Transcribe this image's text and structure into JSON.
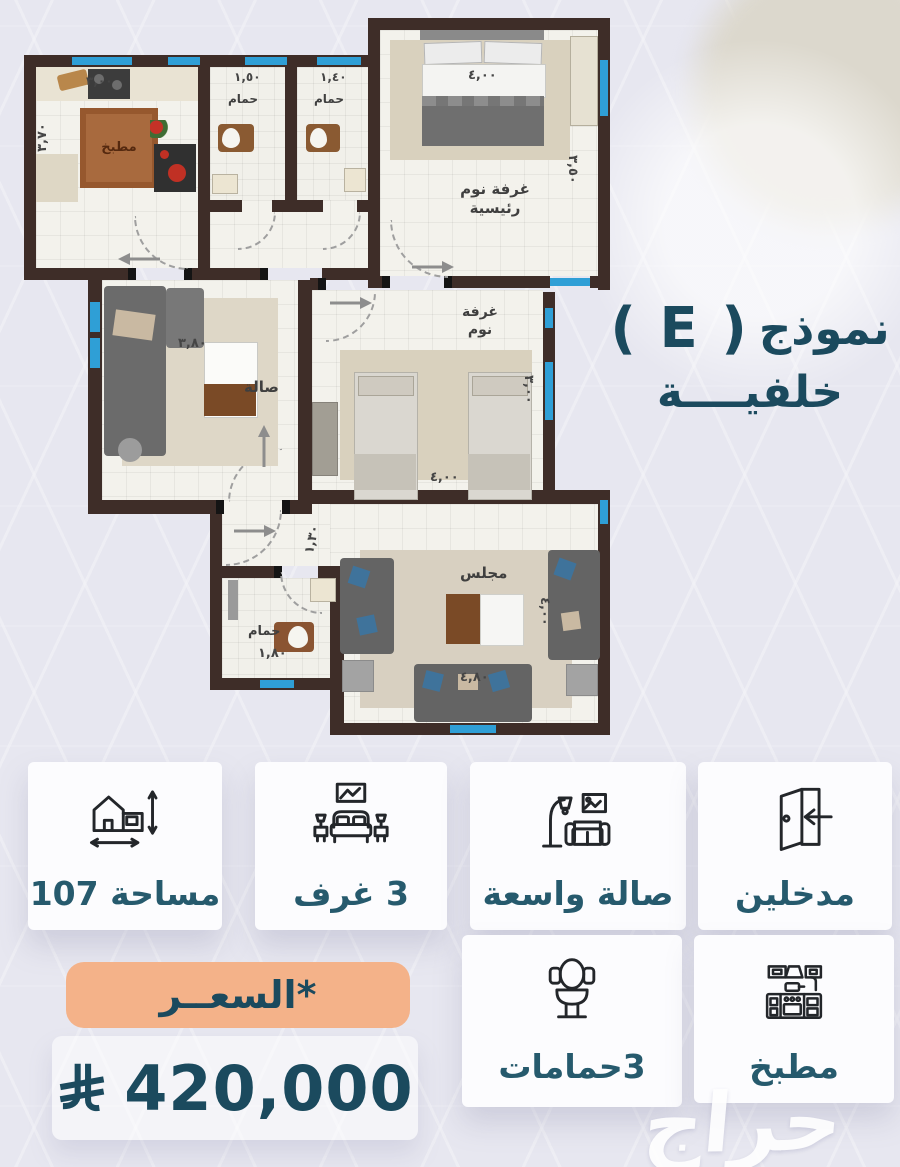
{
  "title": {
    "prefix": "نموذج",
    "model": "( E )",
    "subtitle": "خلفيــــة"
  },
  "watermark": "حراج",
  "floorplan": {
    "kitchen": {
      "rug_label": "مطبخ",
      "dim_top": "٣,٠٠",
      "dim_left": "٣,٧٠"
    },
    "bath1": {
      "label": "حمام",
      "dim": "١,٥٠"
    },
    "bath2": {
      "label": "حمام",
      "dim": "١,٤٠"
    },
    "master": {
      "label1": "غرفة نوم",
      "label2": "رئيسية",
      "dim_width": "٤,٠٠",
      "dim_height": "٣,٥٠"
    },
    "hall": {
      "label": "صالة",
      "dim": "٣,٨٠"
    },
    "bedroom": {
      "label1": "غرفة",
      "label2": "نوم",
      "dim_width": "٤,٠٠",
      "dim_height": "٣,٠٠"
    },
    "entry": {
      "dim": "١,٣٠"
    },
    "bath3": {
      "label": "حمام",
      "dim": "١,٨٠"
    },
    "majlis": {
      "label": "مجلس",
      "dim_width": "٤,٨٠",
      "dim_height": "٤,٠٠"
    }
  },
  "features": [
    {
      "label": "مساحة 107",
      "icon": "house-measure-icon"
    },
    {
      "label": "3 غرف",
      "icon": "bedroom-icon"
    },
    {
      "label": "صالة واسعة",
      "icon": "sofa-lamp-icon"
    },
    {
      "label": "مدخلين",
      "icon": "door-entry-icon"
    },
    {
      "label": "3حمامات",
      "icon": "toilet-icon"
    },
    {
      "label": "مطبخ",
      "icon": "kitchen-icon"
    }
  ],
  "price": {
    "badge": "*السعــر",
    "amount": "420,000",
    "currency_icon": "saudi-riyal-symbol"
  },
  "colors": {
    "teal_text": "#1b4a5e",
    "badge_orange": "#f4b289",
    "wall_brown": "#3e2d28",
    "window_blue": "#2f9fd6",
    "background": "#e7e7f0"
  }
}
